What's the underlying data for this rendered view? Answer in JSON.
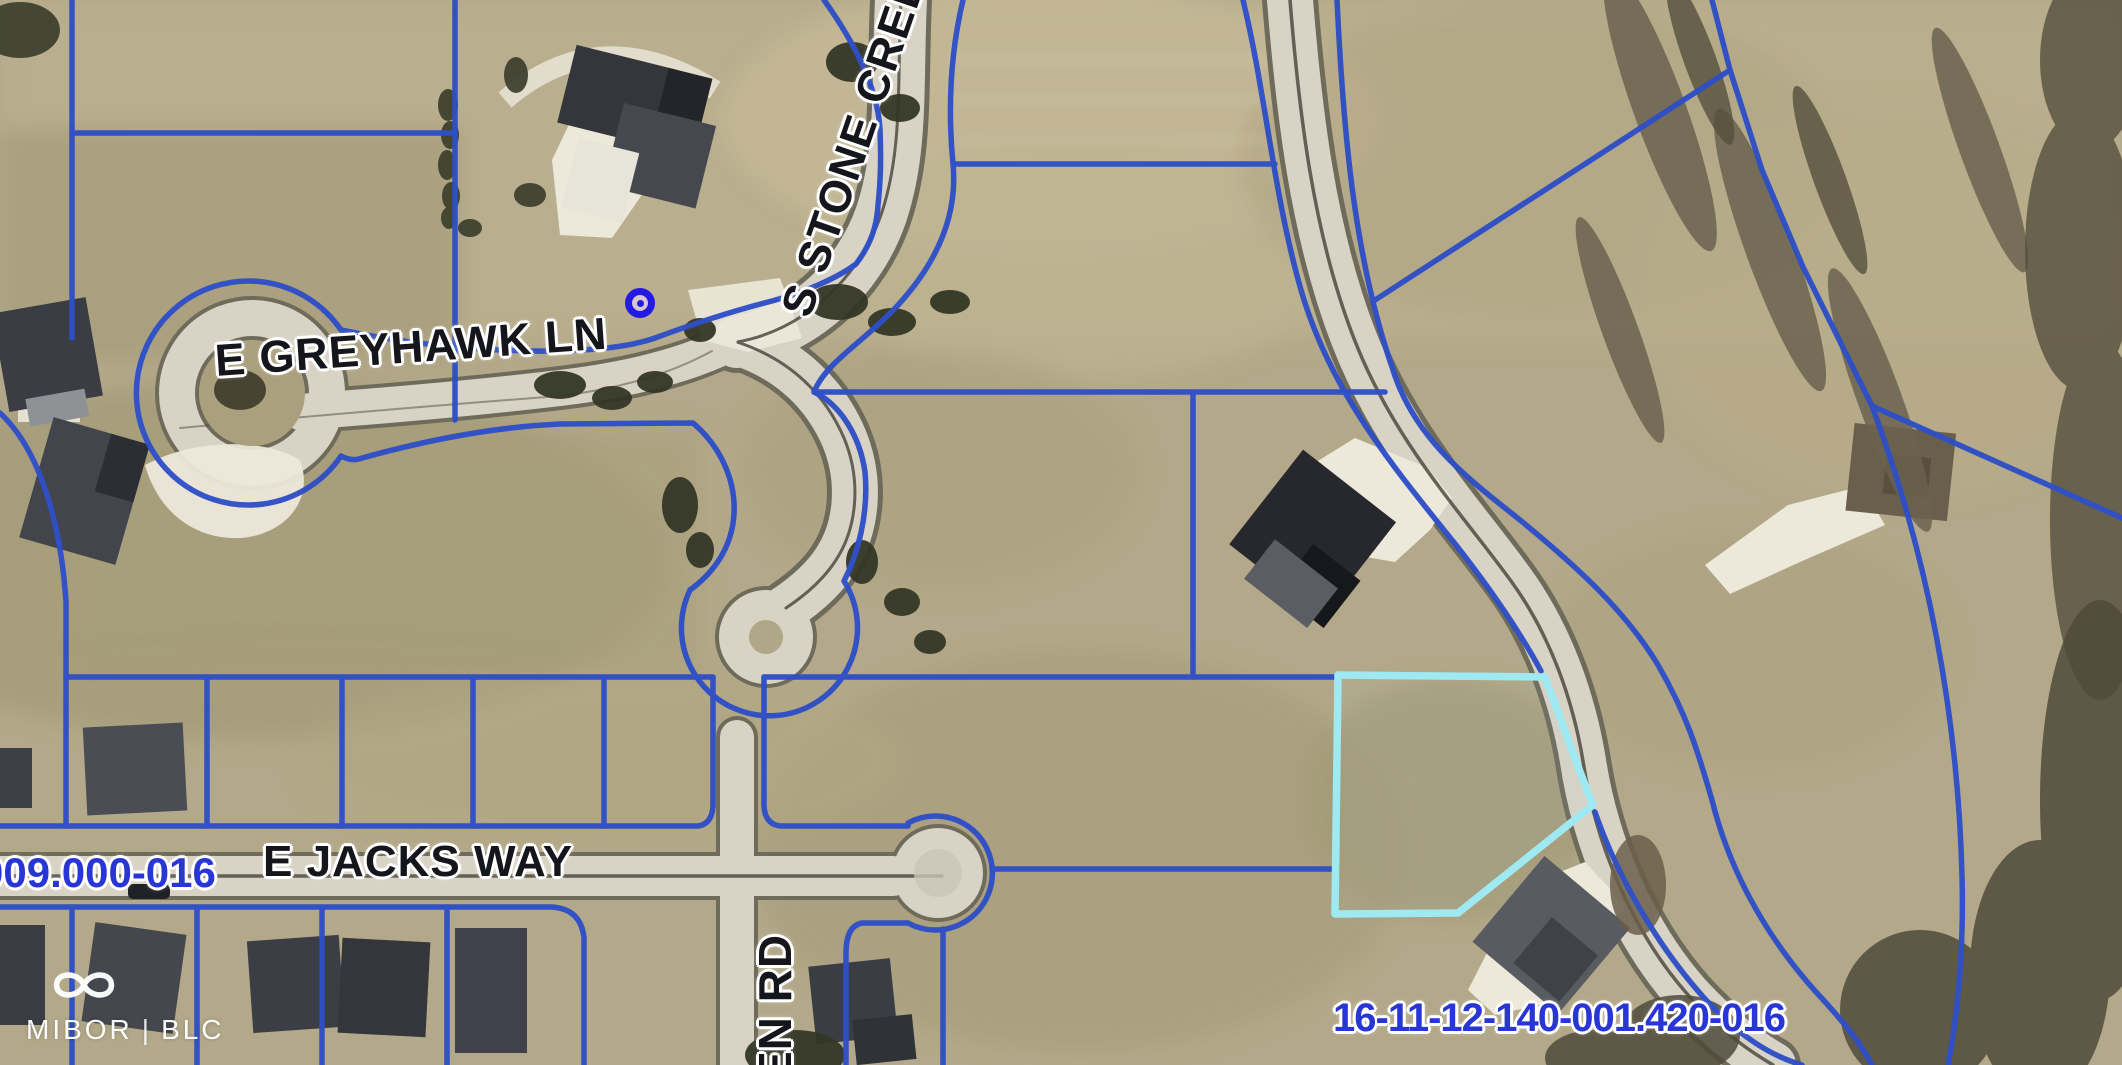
{
  "map": {
    "streets": [
      {
        "name": "E GREYHAWK LN"
      },
      {
        "name": "S STONE CREE"
      },
      {
        "name": "E JACKS WAY"
      },
      {
        "name": "EN RD"
      }
    ],
    "parcel_labels": [
      {
        "value": "009.000-016"
      },
      {
        "value": "16-11-12-140-001.420-016"
      }
    ],
    "highlighted_parcel_id": "16-11-12-140-001.420-016",
    "colors": {
      "parcel_line": "#2e4fc7",
      "highlighted_parcel": "#9fe9f3",
      "street_label": "#15161b",
      "parcel_id_text": "#2936d6",
      "road_fill": "#d8d3c5",
      "field_base": "#b3a98a",
      "marker": "#2519e6"
    }
  },
  "watermark": {
    "brand": "MIBOR",
    "separator": "|",
    "suffix": "BLC"
  }
}
